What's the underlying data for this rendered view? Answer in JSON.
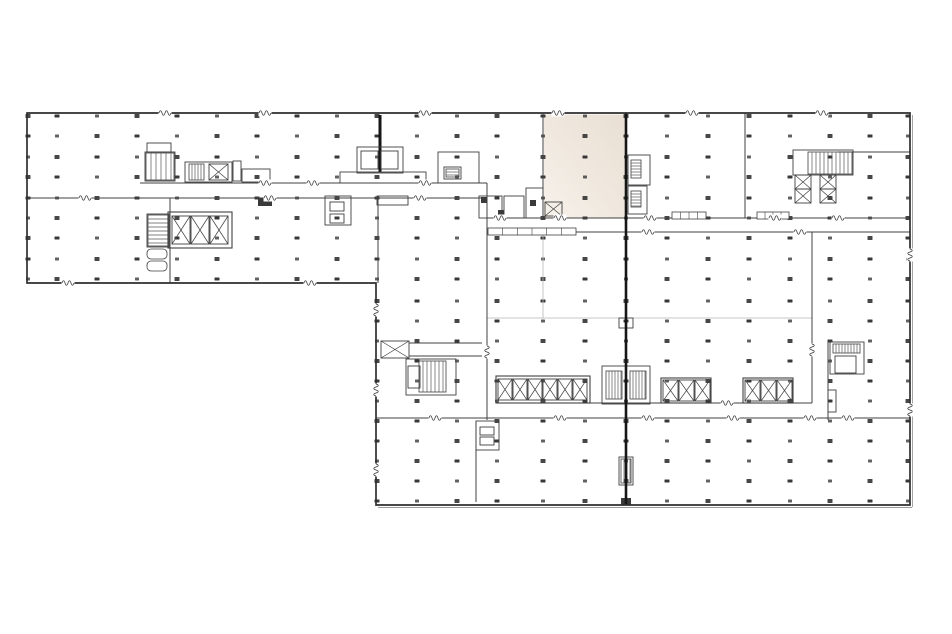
{
  "canvas": {
    "width": 952,
    "height": 634,
    "background": "#ffffff"
  },
  "palette": {
    "wall": "#404040",
    "outline": "#2f2f2f",
    "light_wall": "#b5b5b5",
    "dot": "#2d2d2d",
    "joint": "#161616",
    "dark_fill": "#3a3a3a",
    "hatch": "#565656",
    "highlight_from": "#e9dfd3",
    "highlight_to": "#f6f1ea",
    "double_edge": "#9a9a9a",
    "break_bg": "#ffffff"
  },
  "highlight_room": {
    "x": 544,
    "y": 114.5,
    "w": 81,
    "h": 103,
    "gradient_angle": 215
  },
  "outline": {
    "points": "27,113 910,113 910,505 376,505 376,283 27,283",
    "stroke_w": 1.7
  },
  "double_edges": [
    [
      378,
      507.5,
      912,
      507.5
    ],
    [
      912.5,
      115,
      912.5,
      507
    ]
  ],
  "joint": {
    "x": 626,
    "y1": 113,
    "y2": 505,
    "w": 2.6
  },
  "columns": {
    "cols": [
      28,
      57,
      97,
      137,
      177,
      217,
      257,
      297,
      337,
      377,
      417,
      457,
      497,
      543,
      585,
      626,
      667,
      708,
      749,
      790,
      830,
      870,
      908
    ],
    "top_rows": [
      116,
      136,
      157,
      177,
      198,
      218,
      238,
      259,
      279
    ],
    "low_rows": [
      301,
      321,
      341,
      361,
      381,
      401,
      421,
      441,
      461,
      481,
      501
    ],
    "low_min_x": 377,
    "dot_w": 5,
    "dot_h": 4
  },
  "walls": [
    [
      140,
      183,
      487,
      183
    ],
    [
      27,
      198,
      487,
      198
    ],
    [
      487,
      183,
      487,
      420
    ],
    [
      543,
      114,
      543,
      218
    ],
    [
      487,
      218,
      910,
      218
    ],
    [
      487,
      232,
      910,
      232
    ],
    [
      745,
      113,
      745,
      218
    ],
    [
      838,
      152,
      910,
      152
    ],
    [
      812,
      232,
      812,
      403
    ],
    [
      497,
      403,
      812,
      403
    ],
    [
      376,
      418,
      910,
      418
    ],
    [
      828,
      342,
      828,
      420
    ],
    [
      170,
      198,
      170,
      283
    ],
    [
      378,
      198,
      378,
      283
    ],
    [
      409,
      343,
      482,
      343
    ],
    [
      409,
      356,
      482,
      356
    ],
    [
      476,
      421,
      476,
      502
    ]
  ],
  "stems": [
    [
      380,
      115,
      380,
      172
    ]
  ],
  "light_walls": [
    [
      487,
      318,
      812,
      318
    ],
    [
      543,
      232,
      543,
      318
    ]
  ],
  "rects": [
    [
      145,
      152,
      30,
      29
    ],
    [
      147,
      143,
      24,
      9
    ],
    [
      185,
      162,
      47,
      20
    ],
    [
      242,
      169,
      28,
      13
    ],
    [
      233,
      161,
      8,
      20
    ],
    [
      325,
      196,
      26,
      29
    ],
    [
      330,
      202,
      14,
      9
    ],
    [
      330,
      214,
      14,
      9
    ],
    [
      340,
      172,
      86,
      11
    ],
    [
      357,
      147,
      46,
      26
    ],
    [
      361,
      151,
      17,
      18
    ],
    [
      381,
      151,
      17,
      18
    ],
    [
      377,
      196,
      31,
      9
    ],
    [
      438,
      152,
      41,
      31
    ],
    [
      444,
      167,
      17,
      12
    ],
    [
      479,
      196,
      23,
      22
    ],
    [
      504,
      196,
      20,
      22
    ],
    [
      526,
      188,
      17,
      30
    ],
    [
      628,
      155,
      22,
      30
    ],
    [
      628,
      186,
      19,
      28
    ],
    [
      793,
      150,
      60,
      25
    ],
    [
      602,
      366,
      48,
      38
    ],
    [
      406,
      359,
      50,
      36
    ],
    [
      408,
      366,
      12,
      22
    ],
    [
      830,
      342,
      34,
      32
    ],
    [
      835,
      356,
      21,
      17
    ],
    [
      828,
      390,
      8,
      22
    ],
    [
      476,
      421,
      23,
      29
    ],
    [
      480,
      427,
      14,
      8
    ],
    [
      480,
      437,
      14,
      8
    ],
    [
      147,
      214,
      22,
      33
    ],
    [
      619,
      318,
      14,
      10
    ],
    [
      619,
      457,
      14,
      28
    ]
  ],
  "dark_rects": [
    [
      258,
      198,
      14,
      8
    ],
    [
      481,
      197,
      6,
      6
    ],
    [
      498,
      210,
      6,
      6
    ],
    [
      530,
      200,
      6,
      6
    ],
    [
      621,
      498,
      10,
      7
    ]
  ],
  "hatches": [
    {
      "x": 146,
      "y": 153,
      "w": 28,
      "h": 27,
      "step": 5,
      "dir": "v"
    },
    {
      "x": 189,
      "y": 164,
      "w": 15,
      "h": 16,
      "step": 3,
      "dir": "v"
    },
    {
      "x": 808,
      "y": 152,
      "w": 44,
      "h": 22,
      "step": 4,
      "dir": "v"
    },
    {
      "x": 419,
      "y": 361,
      "w": 27,
      "h": 31,
      "step": 4,
      "dir": "v"
    },
    {
      "x": 606,
      "y": 371,
      "w": 16,
      "h": 28,
      "step": 3,
      "dir": "v"
    },
    {
      "x": 630,
      "y": 371,
      "w": 16,
      "h": 28,
      "step": 3,
      "dir": "v"
    },
    {
      "x": 148,
      "y": 215,
      "w": 20,
      "h": 31,
      "step": 4,
      "dir": "h"
    },
    {
      "x": 631,
      "y": 160,
      "w": 10,
      "h": 18,
      "step": 3,
      "dir": "h"
    },
    {
      "x": 631,
      "y": 191,
      "w": 10,
      "h": 16,
      "step": 3,
      "dir": "h"
    },
    {
      "x": 833,
      "y": 344,
      "w": 27,
      "h": 9,
      "step": 3,
      "dir": "v"
    },
    {
      "x": 446,
      "y": 169,
      "w": 13,
      "h": 8,
      "step": 3,
      "dir": "h"
    },
    {
      "x": 621,
      "y": 459,
      "w": 10,
      "h": 24,
      "step": 3,
      "dir": "v"
    }
  ],
  "xboxes": [
    [
      209,
      164,
      19,
      16
    ],
    [
      381,
      341,
      28,
      17
    ],
    [
      545,
      202,
      17,
      14
    ],
    [
      795,
      175,
      16,
      14
    ],
    [
      795,
      189,
      16,
      14
    ],
    [
      820,
      175,
      16,
      14
    ],
    [
      820,
      189,
      16,
      14
    ]
  ],
  "elevator_banks": [
    {
      "frame": [
        496,
        376,
        94,
        27
      ],
      "cx": 498,
      "cy": 379,
      "cells": 6,
      "cw": 15,
      "ch": 21
    },
    {
      "frame": [
        661,
        378,
        50,
        25
      ],
      "cx": 663,
      "cy": 380,
      "cells": 3,
      "cw": 16,
      "ch": 21
    },
    {
      "frame": [
        743,
        378,
        50,
        25
      ],
      "cx": 745,
      "cy": 380,
      "cells": 3,
      "cw": 16,
      "ch": 21
    },
    {
      "frame": [
        168,
        212,
        64,
        36
      ],
      "cx": 172,
      "cy": 216,
      "cells": 3,
      "cw": 19,
      "ch": 28
    }
  ],
  "rounded_fixtures": [
    [
      147,
      249,
      20,
      10
    ],
    [
      147,
      261,
      20,
      10
    ]
  ],
  "sills": [
    {
      "x": 672,
      "y": 212,
      "w": 34,
      "h": 7,
      "div": 3
    },
    {
      "x": 757,
      "y": 212,
      "w": 32,
      "h": 7,
      "div": 3
    },
    {
      "x": 488,
      "y": 228,
      "w": 88,
      "h": 7,
      "div": 5
    }
  ],
  "door_breaks_h": [
    [
      165,
      113
    ],
    [
      265,
      113
    ],
    [
      425,
      113
    ],
    [
      558,
      113
    ],
    [
      692,
      113
    ],
    [
      822,
      113
    ],
    [
      68,
      283
    ],
    [
      310,
      283
    ],
    [
      265,
      183
    ],
    [
      313,
      183
    ],
    [
      425,
      183
    ],
    [
      85,
      198
    ],
    [
      270,
      198
    ],
    [
      420,
      198
    ],
    [
      500,
      218
    ],
    [
      560,
      218
    ],
    [
      650,
      218
    ],
    [
      775,
      218
    ],
    [
      838,
      218
    ],
    [
      648,
      232
    ],
    [
      800,
      232
    ],
    [
      727,
      403
    ],
    [
      435,
      418
    ],
    [
      560,
      418
    ],
    [
      648,
      418
    ],
    [
      733,
      418
    ],
    [
      810,
      418
    ],
    [
      848,
      418
    ]
  ],
  "door_breaks_v": [
    [
      376,
      310
    ],
    [
      376,
      390
    ],
    [
      376,
      470
    ],
    [
      487,
      352
    ],
    [
      812,
      350
    ],
    [
      910,
      255
    ],
    [
      910,
      410
    ]
  ]
}
